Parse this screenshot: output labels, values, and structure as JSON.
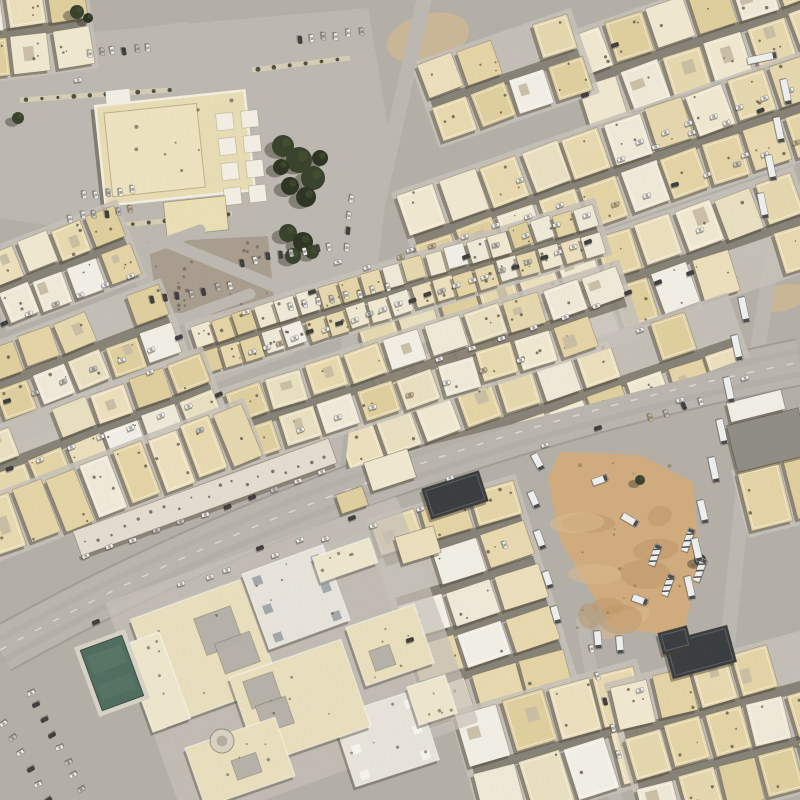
{
  "scene": {
    "kind": "satellite-imagery",
    "description": "Aerial satellite view of a desert city residential district with beige flat-roofed houses, a diagonal arterial avenue, a mosque compound with parking, a school complex with a teal court, and a dirt truck lot"
  },
  "palette": {
    "ground": "#b3afa7",
    "road_light": "#bcb8b1",
    "sidewalk": "#c6c1b8",
    "avenue": "#b9b5ae",
    "avenue_edge": "#a19d96",
    "lane_mark": "#f4f2ec",
    "tire_streak": "#a8a49d",
    "house_tones": [
      "#ecdfbc",
      "#e8d9ae",
      "#e4d4a5",
      "#f0e8cf",
      "#e9e0c0",
      "#dfcf9e",
      "#efe9d8",
      "#e6d8ad"
    ],
    "house_white": "#f2efe6",
    "house_stroke": "rgba(90,78,52,0.40)",
    "parapet": "rgba(255,255,255,0.55)",
    "courtyard": "#c7bda2",
    "alley_shadow": "#4a4336",
    "house_shadow": "#453f2f",
    "speckle": "#4e4738",
    "gravel": "#a89d8d",
    "sand": "#cdb794",
    "dirt": "#d1ab7c",
    "dirt_light": "#debc90",
    "dirt_dark": "#bd9566",
    "tree": "#2b3220",
    "tree_light": "#47552f",
    "tree_shadow": "#3c392e",
    "pool": "#4d6d5e",
    "pool_light": "#5f7f6e",
    "deck": "#d7d2c6",
    "roof_gray": "#8f8c86",
    "roof_white": "#e7e4dc",
    "roof_dot": "#9aa0a4",
    "dark_roof": "#383b3e",
    "car_white": "#f2f1ed",
    "car_dark": "#3b3b3b",
    "car_silver": "#c9c7c1",
    "car_tan": "#cbb792",
    "truck": "#eef0ef",
    "island": "#d6cdb4"
  },
  "avenue": {
    "p0": [
      0,
      650
    ],
    "c": [
      360,
      450
    ],
    "p1": [
      800,
      362
    ],
    "width": 44
  },
  "roads": [
    {
      "pts": [
        [
          424,
          0
        ],
        [
          352,
          318
        ],
        [
          332,
          470
        ]
      ],
      "w": 15
    },
    {
      "pts": [
        [
          788,
          162
        ],
        [
          757,
          352
        ],
        [
          712,
          800
        ]
      ],
      "w": 15
    },
    {
      "pts": [
        [
          0,
          52
        ],
        [
          185,
          28
        ]
      ],
      "w": 12
    },
    {
      "pts": [
        [
          0,
          212
        ],
        [
          150,
          235
        ],
        [
          352,
          318
        ]
      ],
      "w": 12
    },
    {
      "pts": [
        [
          604,
          150
        ],
        [
          800,
          82
        ]
      ],
      "w": 12
    },
    {
      "pts": [
        [
          436,
          268
        ],
        [
          800,
          142
        ]
      ],
      "w": 13
    },
    {
      "pts": [
        [
          404,
          372
        ],
        [
          760,
          248
        ]
      ],
      "w": 13
    },
    {
      "pts": [
        [
          0,
          303
        ],
        [
          200,
          230
        ]
      ],
      "w": 11
    },
    {
      "pts": [
        [
          0,
          385
        ],
        [
          250,
          294
        ]
      ],
      "w": 11
    },
    {
      "pts": [
        [
          0,
          455
        ],
        [
          290,
          350
        ]
      ],
      "w": 11
    },
    {
      "pts": [
        [
          138,
          622
        ],
        [
          455,
          505
        ]
      ],
      "w": 13
    },
    {
      "pts": [
        [
          582,
          622
        ],
        [
          616,
          800
        ]
      ],
      "w": 13
    },
    {
      "pts": [
        [
          365,
          272
        ],
        [
          590,
          200
        ]
      ],
      "w": 11
    },
    {
      "pts": [
        [
          252,
          356
        ],
        [
          592,
          246
        ]
      ],
      "w": 12
    }
  ],
  "compound": {
    "polygon": [
      [
        0,
        40
      ],
      [
        368,
        8
      ],
      [
        392,
        150
      ],
      [
        372,
        310
      ],
      [
        150,
        318
      ],
      [
        118,
        240
      ],
      [
        0,
        212
      ]
    ],
    "islands": [
      {
        "x1": 20,
        "y1": 100,
        "x2": 170,
        "y2": 90,
        "w": 5
      },
      {
        "x1": 95,
        "y1": 228,
        "x2": 232,
        "y2": 214,
        "w": 5
      },
      {
        "x1": 252,
        "y1": 70,
        "x2": 350,
        "y2": 58,
        "w": 5
      }
    ],
    "gravel": [
      [
        148,
        242
      ],
      [
        268,
        236
      ],
      [
        274,
        300
      ],
      [
        240,
        316
      ],
      [
        158,
        312
      ]
    ],
    "sand_patches": [
      {
        "cx": 428,
        "cy": 38,
        "rx": 42,
        "ry": 24,
        "rot": -15
      },
      {
        "cx": 782,
        "cy": 298,
        "rx": 26,
        "ry": 13,
        "rot": -14
      },
      {
        "cx": 318,
        "cy": 330,
        "rx": 30,
        "ry": 12,
        "rot": -18
      }
    ],
    "main_building": {
      "cx": 175,
      "cy": 148,
      "w": 150,
      "h": 100,
      "rot": -6
    },
    "pads": {
      "cx": 236,
      "cy": 146,
      "cols": 2,
      "rows": 4,
      "size": 17,
      "gap": 8,
      "rot": -6
    },
    "annex": {
      "cx": 196,
      "cy": 216,
      "w": 62,
      "h": 34,
      "rot": -6
    },
    "white_hut": {
      "cx": 118,
      "cy": 97,
      "w": 24,
      "h": 14,
      "rot": -6
    }
  },
  "blocks": [
    {
      "name": "block-ne-1",
      "cx": 700,
      "cy": 40,
      "w": 260,
      "h": 92,
      "rot": -19,
      "rows": 2,
      "cols": 6,
      "clip": "ne"
    },
    {
      "name": "block-ne-1b",
      "cx": 505,
      "cy": 78,
      "w": 160,
      "h": 80,
      "rot": -19,
      "rows": 2,
      "cols": 4,
      "clip": "ne"
    },
    {
      "name": "block-ne-2",
      "cx": 616,
      "cy": 170,
      "w": 430,
      "h": 94,
      "rot": -19,
      "rows": 2,
      "cols": 10,
      "clip": "ne"
    },
    {
      "name": "block-ne-3",
      "cx": 588,
      "cy": 292,
      "w": 460,
      "h": 94,
      "rot": -19,
      "rows": 2,
      "cols": 11,
      "clip": "ne"
    },
    {
      "name": "block-ne-4",
      "cx": 545,
      "cy": 407,
      "w": 410,
      "h": 88,
      "rot": -19,
      "rows": 2,
      "cols": 10,
      "clip": "ne"
    },
    {
      "name": "block-terrace",
      "cx": 398,
      "cy": 289,
      "w": 420,
      "h": 50,
      "rot": -17,
      "rows": 2,
      "cols": 19,
      "small": true
    },
    {
      "name": "block-center",
      "cx": 432,
      "cy": 363,
      "w": 410,
      "h": 72,
      "rot": -18,
      "rows": 2,
      "cols": 10
    },
    {
      "name": "block-corner",
      "cx": 28,
      "cy": 30,
      "w": 120,
      "h": 85,
      "rot": -8,
      "rows": 2,
      "cols": 3
    },
    {
      "name": "block-w-3",
      "cx": 62,
      "cy": 265,
      "w": 140,
      "h": 74,
      "rot": -21,
      "rows": 2,
      "cols": 4
    },
    {
      "name": "block-w-2",
      "cx": 82,
      "cy": 352,
      "w": 190,
      "h": 72,
      "rot": -21,
      "rows": 2,
      "cols": 5
    },
    {
      "name": "block-w-2b",
      "cx": 100,
      "cy": 428,
      "w": 240,
      "h": 70,
      "rot": -21,
      "rows": 2,
      "cols": 6
    },
    {
      "name": "block-w-1",
      "cx": 120,
      "cy": 480,
      "w": 280,
      "h": 56,
      "rot": -21,
      "rows": 1,
      "cols": 8
    },
    {
      "name": "block-s-2",
      "cx": 472,
      "cy": 602,
      "w": 148,
      "h": 210,
      "rot": -17,
      "rows": 5,
      "cols": 3
    },
    {
      "name": "block-s-3",
      "cx": 560,
      "cy": 745,
      "w": 185,
      "h": 115,
      "rot": -16,
      "rows": 2,
      "cols": 4
    },
    {
      "name": "block-s-4",
      "cx": 728,
      "cy": 732,
      "w": 205,
      "h": 148,
      "rot": -15,
      "rows": 3,
      "cols": 5
    },
    {
      "name": "block-e-5",
      "cx": 788,
      "cy": 492,
      "w": 90,
      "h": 60,
      "rot": -14,
      "rows": 1,
      "cols": 2
    }
  ],
  "ne_clip": [
    [
      430,
      0
    ],
    [
      800,
      0
    ],
    [
      800,
      338
    ],
    [
      700,
      375
    ],
    [
      560,
      412
    ],
    [
      430,
      445
    ],
    [
      345,
      470
    ],
    [
      360,
      315
    ]
  ],
  "strip_building": {
    "cx": 205,
    "cy": 497,
    "w": 272,
    "h": 26,
    "rot": -20
  },
  "school": {
    "base": {
      "cx": 292,
      "cy": 662,
      "w": 310,
      "h": 240,
      "rot": -20
    },
    "structures": [
      {
        "kind": "court",
        "cx": 205,
        "cy": 652,
        "w": 118,
        "h": 112,
        "rot": -20,
        "holes": 2
      },
      {
        "kind": "roof",
        "cx": 296,
        "cy": 597,
        "w": 86,
        "h": 80,
        "rot": -20,
        "dot": "gray"
      },
      {
        "kind": "roof",
        "cx": 386,
        "cy": 738,
        "w": 88,
        "h": 74,
        "rot": -18,
        "dot": "white"
      },
      {
        "kind": "court",
        "cx": 300,
        "cy": 702,
        "w": 118,
        "h": 92,
        "rot": -19,
        "holes": 2
      },
      {
        "kind": "court",
        "cx": 390,
        "cy": 645,
        "w": 72,
        "h": 62,
        "rot": -19,
        "holes": 1
      },
      {
        "kind": "court",
        "cx": 240,
        "cy": 762,
        "w": 95,
        "h": 62,
        "rot": -19,
        "holes": 1
      },
      {
        "kind": "plain",
        "cx": 156,
        "cy": 682,
        "w": 40,
        "h": 92,
        "rot": -20
      },
      {
        "kind": "plain",
        "cx": 345,
        "cy": 560,
        "w": 60,
        "h": 26,
        "rot": -19
      },
      {
        "kind": "plain",
        "cx": 432,
        "cy": 700,
        "w": 40,
        "h": 40,
        "rot": -18
      }
    ],
    "pool": {
      "cx": 112,
      "cy": 673,
      "w": 44,
      "h": 64,
      "rot": -20
    },
    "circle_feature": {
      "cx": 222,
      "cy": 741,
      "r": 12
    }
  },
  "dirt_lot": {
    "polygon": [
      [
        560,
        452
      ],
      [
        640,
        455
      ],
      [
        693,
        482
      ],
      [
        700,
        560
      ],
      [
        683,
        636
      ],
      [
        612,
        628
      ],
      [
        560,
        540
      ],
      [
        548,
        478
      ]
    ],
    "mottles": 10
  },
  "special_buildings": [
    {
      "name": "dark-roof-bldg-1",
      "cx": 455,
      "cy": 495,
      "w": 60,
      "h": 32,
      "rot": -18,
      "fill": "dark_roof"
    },
    {
      "name": "dark-roof-bldg-2",
      "cx": 700,
      "cy": 652,
      "w": 66,
      "h": 38,
      "rot": -15,
      "fill": "dark_roof"
    },
    {
      "name": "dark-roof-bldg-3",
      "cx": 675,
      "cy": 640,
      "w": 30,
      "h": 22,
      "rot": -15,
      "fill": "dark_roof"
    },
    {
      "name": "warehouse",
      "cx": 768,
      "cy": 440,
      "w": 74,
      "h": 48,
      "rot": -14,
      "fill": "roof_gray"
    },
    {
      "name": "warehouse-wing",
      "cx": 756,
      "cy": 406,
      "w": 56,
      "h": 20,
      "rot": -14,
      "fill": "house_white"
    },
    {
      "name": "house-single-1",
      "cx": 390,
      "cy": 470,
      "w": 46,
      "h": 30,
      "rot": -18,
      "fill": "beige"
    },
    {
      "name": "house-single-2",
      "cx": 352,
      "cy": 500,
      "w": 28,
      "h": 20,
      "rot": -19,
      "fill": "beige"
    },
    {
      "name": "house-single-3",
      "cx": 418,
      "cy": 545,
      "w": 40,
      "h": 28,
      "rot": -17,
      "fill": "beige"
    }
  ],
  "trees": [
    {
      "name": "tree-cluster-courtyard",
      "blobs": [
        [
          283,
          146,
          11
        ],
        [
          299,
          160,
          13
        ],
        [
          313,
          178,
          12
        ],
        [
          290,
          186,
          9
        ],
        [
          320,
          158,
          8
        ],
        [
          306,
          197,
          10
        ],
        [
          281,
          167,
          8
        ]
      ]
    },
    {
      "name": "tree-cluster-south",
      "blobs": [
        [
          288,
          233,
          9
        ],
        [
          303,
          242,
          10
        ],
        [
          293,
          256,
          8
        ],
        [
          312,
          252,
          7
        ]
      ]
    },
    {
      "name": "tree-corner",
      "blobs": [
        [
          77,
          12,
          7
        ],
        [
          88,
          18,
          5
        ]
      ]
    },
    {
      "name": "tree-west",
      "blobs": [
        [
          18,
          118,
          6
        ]
      ]
    },
    {
      "name": "tree-lot",
      "blobs": [
        [
          700,
          560,
          6
        ],
        [
          640,
          480,
          5
        ]
      ]
    }
  ],
  "car_rows": [
    {
      "x1": 90,
      "y1": 54,
      "x2": 148,
      "y2": 48,
      "n": 6,
      "perp": true
    },
    {
      "x1": 300,
      "y1": 40,
      "x2": 362,
      "y2": 33,
      "n": 6,
      "perp": true
    },
    {
      "x1": 84,
      "y1": 196,
      "x2": 132,
      "y2": 190,
      "n": 5,
      "perp": true
    },
    {
      "x1": 70,
      "y1": 218,
      "x2": 130,
      "y2": 210,
      "n": 6,
      "perp": true
    },
    {
      "x1": 152,
      "y1": 300,
      "x2": 230,
      "y2": 286,
      "n": 7,
      "perp": true,
      "dark": true
    },
    {
      "x1": 242,
      "y1": 262,
      "x2": 330,
      "y2": 246,
      "n": 8,
      "perp": true,
      "dark": true
    },
    {
      "x1": 292,
      "y1": 308,
      "x2": 388,
      "y2": 288,
      "n": 8,
      "perp": true
    },
    {
      "x1": 352,
      "y1": 200,
      "x2": 346,
      "y2": 248,
      "n": 4,
      "perp": false
    },
    {
      "x1": 252,
      "y1": 352,
      "x2": 588,
      "y2": 243,
      "n": 24,
      "perp": false,
      "dark": true
    },
    {
      "x1": 368,
      "y1": 268,
      "x2": 560,
      "y2": 205,
      "n": 7,
      "perp": false
    },
    {
      "x1": 300,
      "y1": 430,
      "x2": 520,
      "y2": 360,
      "n": 7,
      "perp": false
    },
    {
      "x1": 466,
      "y1": 256,
      "x2": 796,
      "y2": 143,
      "n": 12,
      "perp": false
    },
    {
      "x1": 440,
      "y1": 360,
      "x2": 690,
      "y2": 272,
      "n": 9,
      "perp": false
    },
    {
      "x1": 640,
      "y1": 142,
      "x2": 790,
      "y2": 90,
      "n": 7,
      "perp": false
    },
    {
      "x1": 622,
      "y1": 158,
      "x2": 760,
      "y2": 110,
      "n": 5,
      "perp": false
    },
    {
      "x1": 4,
      "y1": 322,
      "x2": 130,
      "y2": 276,
      "n": 6,
      "perp": false
    },
    {
      "x1": 6,
      "y1": 402,
      "x2": 180,
      "y2": 338,
      "n": 7,
      "perp": false
    },
    {
      "x1": 10,
      "y1": 470,
      "x2": 220,
      "y2": 395,
      "n": 8,
      "perp": false
    },
    {
      "x1": 86,
      "y1": 556,
      "x2": 322,
      "y2": 472,
      "n": 11,
      "perp": false
    },
    {
      "x1": 30,
      "y1": 692,
      "x2": 82,
      "y2": 790,
      "n": 8,
      "perp": true,
      "dark": true
    },
    {
      "x1": 4,
      "y1": 724,
      "x2": 48,
      "y2": 800,
      "n": 6,
      "perp": true
    },
    {
      "x1": 180,
      "y1": 585,
      "x2": 420,
      "y2": 510,
      "n": 6,
      "perp": false
    },
    {
      "x1": 592,
      "y1": 648,
      "x2": 620,
      "y2": 755,
      "n": 5,
      "perp": false
    },
    {
      "x1": 652,
      "y1": 418,
      "x2": 700,
      "y2": 402,
      "n": 4,
      "perp": true
    }
  ],
  "avenue_cars": [
    [
      96,
      622,
      -22,
      "dark"
    ],
    [
      210,
      577,
      -21,
      "white"
    ],
    [
      300,
      540,
      -20,
      "white"
    ],
    [
      352,
      518,
      -20,
      "dark"
    ],
    [
      450,
      478,
      -19,
      "white"
    ],
    [
      545,
      445,
      -18,
      "white"
    ],
    [
      598,
      428,
      -17,
      "dark"
    ],
    [
      680,
      400,
      -16,
      "white"
    ],
    [
      745,
      378,
      -16,
      "white"
    ]
  ],
  "single_cars": [
    [
      246,
      312,
      -17,
      "white"
    ],
    [
      312,
      292,
      -17,
      "dark"
    ],
    [
      338,
      262,
      -17,
      "white"
    ],
    [
      410,
      250,
      -18,
      "white"
    ],
    [
      520,
      180,
      -19,
      "white"
    ],
    [
      585,
      95,
      -19,
      "dark"
    ],
    [
      700,
      230,
      -19,
      "white"
    ],
    [
      745,
      155,
      -19,
      "white"
    ],
    [
      640,
      330,
      -18,
      "white"
    ],
    [
      200,
      430,
      -21,
      "silver"
    ],
    [
      150,
      372,
      -21,
      "white"
    ],
    [
      260,
      548,
      -20,
      "dark"
    ],
    [
      505,
      545,
      70,
      "white"
    ],
    [
      640,
      690,
      -16,
      "white"
    ],
    [
      410,
      640,
      -17,
      "dark"
    ],
    [
      78,
      80,
      -8,
      "white"
    ],
    [
      615,
      45,
      -19,
      "dark"
    ]
  ],
  "trucks": [
    {
      "x": 538,
      "y": 462,
      "rot": 62,
      "len": 18
    },
    {
      "x": 534,
      "y": 500,
      "rot": 66,
      "len": 18
    },
    {
      "x": 540,
      "y": 540,
      "rot": 70,
      "len": 20
    },
    {
      "x": 548,
      "y": 580,
      "rot": 72,
      "len": 18
    },
    {
      "x": 556,
      "y": 615,
      "rot": 74,
      "len": 18
    },
    {
      "x": 600,
      "y": 480,
      "rot": -20,
      "len": 16
    },
    {
      "x": 630,
      "y": 520,
      "rot": 30,
      "len": 18
    },
    {
      "x": 655,
      "y": 555,
      "rot": -70,
      "len": 22,
      "striped": true
    },
    {
      "x": 668,
      "y": 585,
      "rot": -70,
      "len": 22,
      "striped": true
    },
    {
      "x": 640,
      "y": 600,
      "rot": 20,
      "len": 16
    },
    {
      "x": 598,
      "y": 640,
      "rot": 85,
      "len": 18
    },
    {
      "x": 620,
      "y": 645,
      "rot": 85,
      "len": 18
    },
    {
      "x": 688,
      "y": 540,
      "rot": -70,
      "len": 24,
      "striped": true
    },
    {
      "x": 700,
      "y": 570,
      "rot": -70,
      "len": 24,
      "striped": true
    },
    {
      "x": 762,
      "y": 58,
      "rot": -12,
      "len": 30
    }
  ],
  "trailer_rows": [
    {
      "items": [
        [
          786,
          92
        ],
        [
          779,
          130
        ],
        [
          771,
          168
        ],
        [
          763,
          206
        ]
      ],
      "rot": 78,
      "len": 26
    },
    {
      "items": [
        [
          744,
          310
        ],
        [
          737,
          348
        ],
        [
          729,
          390
        ],
        [
          722,
          432
        ],
        [
          714,
          470
        ]
      ],
      "rot": 78,
      "len": 26
    },
    {
      "items": [
        [
          703,
          512
        ],
        [
          697,
          550
        ],
        [
          690,
          588
        ]
      ],
      "rot": 77,
      "len": 24
    }
  ]
}
